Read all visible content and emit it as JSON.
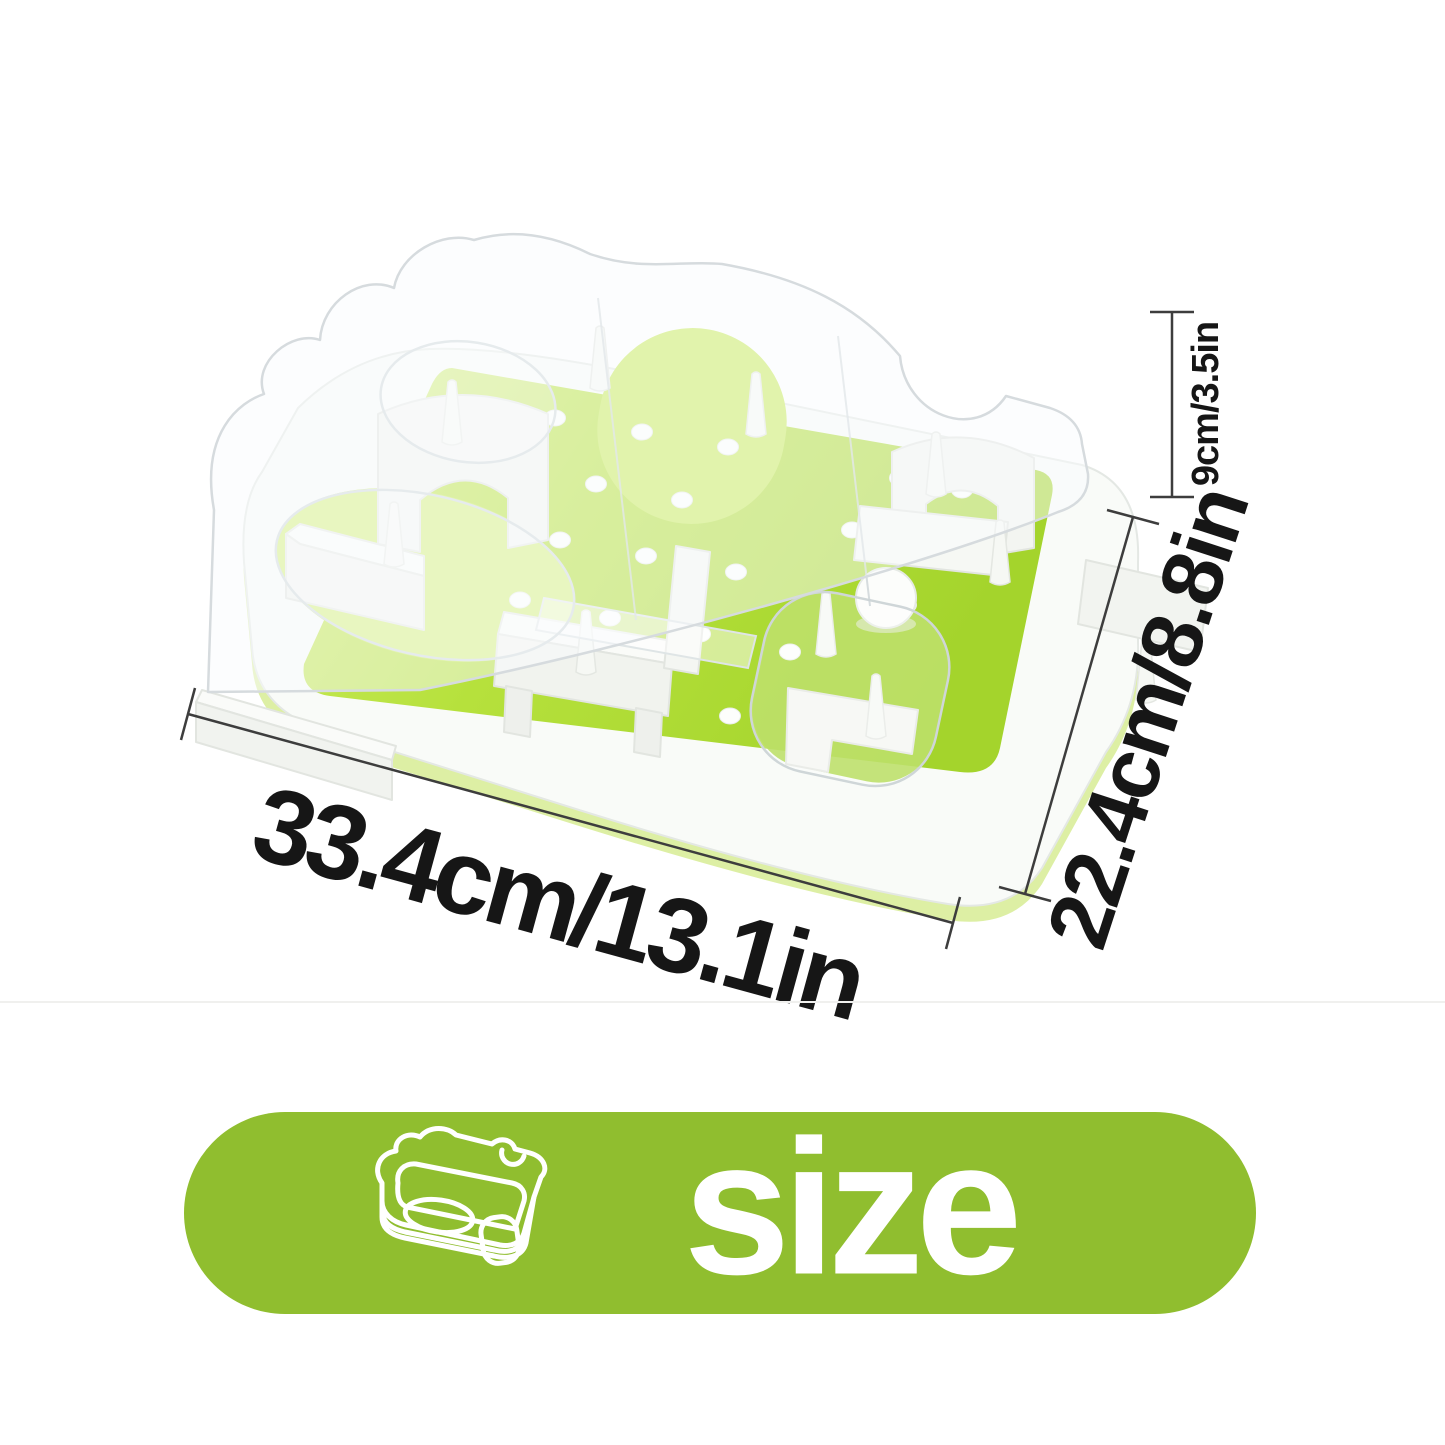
{
  "annotations": {
    "width": {
      "label": "33.4cm/13.1in"
    },
    "depth": {
      "label": "22.4cm/8.8in"
    },
    "height": {
      "label": "9cm/3.5in"
    }
  },
  "banner": {
    "label": "size",
    "icon": "feeder-outline-icon",
    "background_color": "#90be2f",
    "text_color": "#ffffff"
  },
  "product": {
    "kind": "pet-puzzle-feeder-photo",
    "colors": {
      "deck_green": "#b4e039",
      "deck_green_light": "#cbed5f",
      "deck_green_dark": "#a2d32a",
      "tray_white": "#f9fbf8",
      "tray_shadow_green": "#ddefa4",
      "lid_edge_gray": "#d6dbde",
      "dimension_line": "#3d3d3d",
      "label_text": "#161616"
    }
  }
}
